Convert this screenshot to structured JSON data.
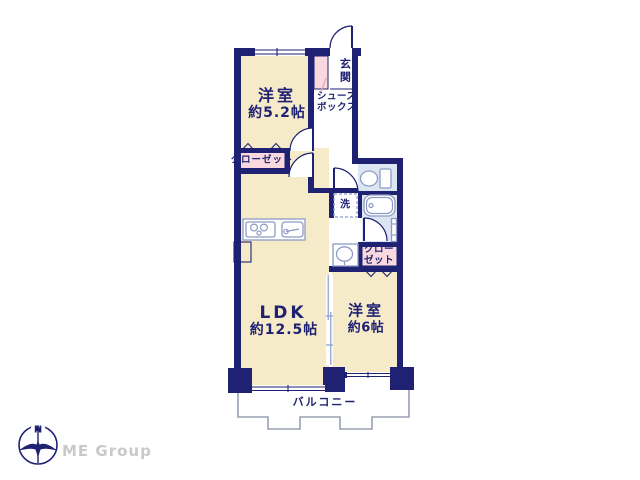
{
  "palette": {
    "wall_navy": "#1f2173",
    "room_cream": "#f6ebc9",
    "closet_pink": "#f9d9de",
    "wet_blue": "#dce6f3",
    "fixture_stroke": "#8d9bc4",
    "balcony_gray": "#98a0b4",
    "brand_gray": "#c9c9c9",
    "background": "#ffffff"
  },
  "floor_plan": {
    "rooms": {
      "bedroom_west": {
        "name": "洋室",
        "size": "約5.2帖"
      },
      "ldk": {
        "name": "LDK",
        "size": "約12.5帖"
      },
      "bedroom_east": {
        "name": "洋室",
        "size": "約6帖"
      },
      "entrance": {
        "name": "玄関"
      },
      "shoe_box": {
        "name": "シューズ\nボックス"
      },
      "closet_west": {
        "name": "クローゼット"
      },
      "closet_east": {
        "name": "クロー\nゼット"
      },
      "laundry": {
        "name": "洗"
      },
      "balcony": {
        "name": "バルコニー"
      }
    },
    "compass": {
      "north_label": "N"
    },
    "brand": {
      "name": "ME Group"
    }
  }
}
